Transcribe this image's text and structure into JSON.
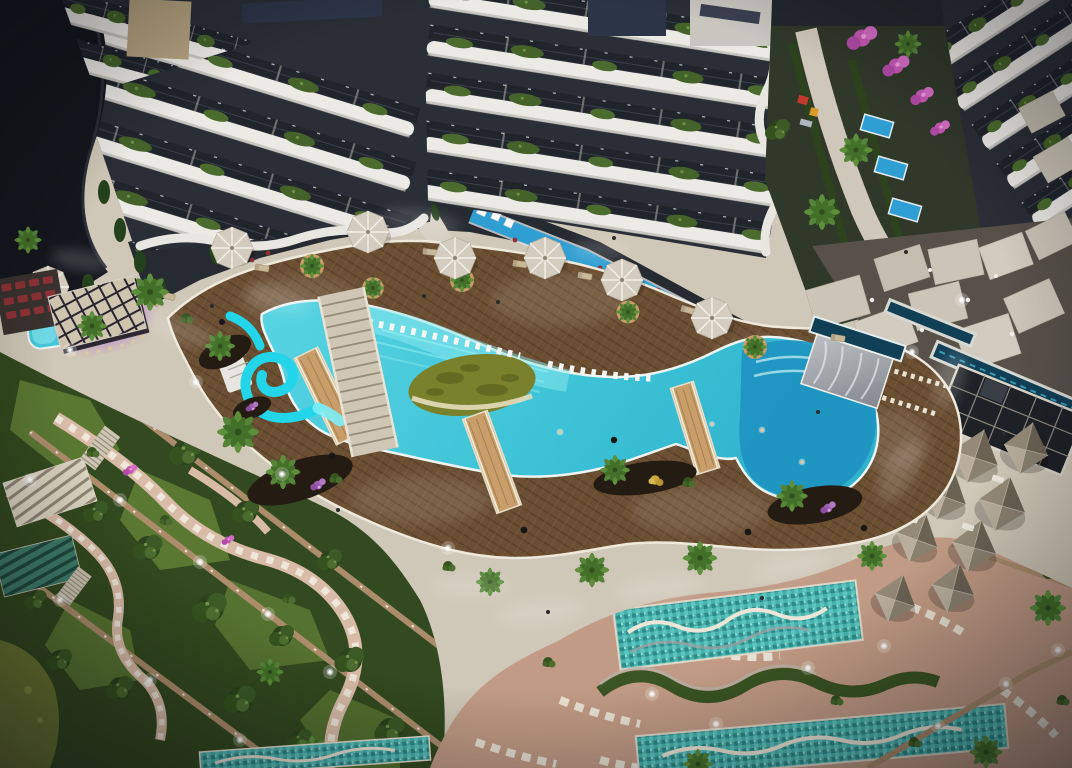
{
  "scene": {
    "title": "Aerial night rendering of a luxury resort residence with lagoon pool",
    "type": "architectural-visualization",
    "view": "top-down aerial, evening artificial lighting",
    "features": [
      "curved white residential towers with planted balconies",
      "free-form turquoise lagoon pool with green island",
      "cyan waterslide",
      "three wooden bridges over pool",
      "dark herringbone wooden pool deck",
      "beige octagonal sun umbrellas",
      "round timber palm planters",
      "in-water sun loungers",
      "deep blue lobe pool with marble cascade and infinity edge",
      "pool bar with slatted roof and purple lighting",
      "pyramid-roof cabanas",
      "white sail shades",
      "glass-grid pavilion roof",
      "infinity water channel",
      "terraced gardens with winding stone paths and lit retaining walls",
      "mosaic-tiled leisure pools with wavy dividers",
      "serpentine hedge ribbon",
      "courtyard garden with pink bougainvillea and playground",
      "private lap pools along tower bases",
      "olive garden pond"
    ]
  },
  "objects": {
    "towers": 4,
    "umbrellas": 7,
    "bridges": 3,
    "cabana_pyramids": 8,
    "mosaic_pools": 3,
    "waterslides": 1,
    "pool_islands": 1
  },
  "colors": {
    "concrete": "#cfc7b7",
    "concreteLight": "#e9e3d4",
    "deckWood": "#6b4f33",
    "deckDark": "#513a24",
    "deckLight": "#8a6845",
    "woodTan": "#c89e6a",
    "poolWater": "#45c9da",
    "poolShallow": "#8ceaf0",
    "poolDeep": "#1e93c1",
    "poolRim": "#eef4f2",
    "slideCyan": "#22d5e8",
    "islandGreen": "#79812d",
    "sandRim": "#e5dcba",
    "vegetation": "#4c6c2f",
    "vegetationDark": "#2c431d",
    "lawn": "#5f7d35",
    "palmGreen": "#5d8f3c",
    "hedge": "#3a5423",
    "umbrella": "#d4cdbf",
    "cabana": "#8d8272",
    "slabWhite": "#eceae5",
    "windowDark": "#20242b",
    "roofNavy": "#2c3547",
    "darkMass": "#14171d",
    "privatePool": "#2f9ed2",
    "bougainvillea": "#c558b4",
    "terracotta": "#c19b85",
    "stoneWhite": "#ece6d9",
    "wallStone": "#ab8d6c",
    "mosaic": "#46b1ad",
    "pond": "#6f7a31",
    "maroonFurniture": "#8e3338",
    "channelTeal": "#113f55",
    "glassDark": "#1e2126"
  }
}
